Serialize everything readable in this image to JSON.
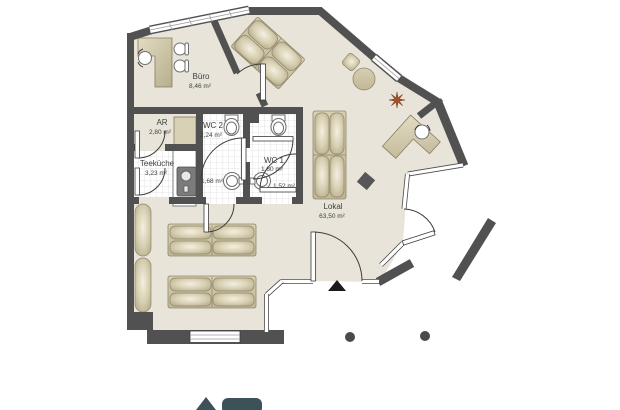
{
  "plan": {
    "type": "floor-plan",
    "rooms": [
      {
        "name": "Büro",
        "area": "8,46 m²"
      },
      {
        "name": "AR",
        "area": "2,80 m²"
      },
      {
        "name": "WC 2",
        "area": "2,24 m²"
      },
      {
        "name": "Teeküche",
        "area": "3,23 m²"
      },
      {
        "name": "WC 1",
        "area": "1,80 m²"
      },
      {
        "name": "",
        "area": "1,68 m²"
      },
      {
        "name": "",
        "area": "1,52 m²"
      },
      {
        "name": "Lokal",
        "area": "63,50 m²"
      }
    ],
    "colors": {
      "background": "#ffffff",
      "floor": "#e9e4d9",
      "wall": "#515151",
      "furniture": "#cdc4a4",
      "tile_line": "#dcdcdc",
      "plant": "#9c5429",
      "entrance_marker": "#1a1a1a",
      "column": "#4a4a4a",
      "logo": "#3d5159"
    },
    "icons": [
      "toilet-icon",
      "wash-basin-icon",
      "kitchen-sink-icon",
      "desk-icon",
      "office-chair-icon",
      "bench-seat-icon",
      "round-table-icon",
      "plant-starburst-icon",
      "entrance-arrow-icon",
      "column-icon",
      "logo-house-icon",
      "logo-badge-icon"
    ]
  }
}
